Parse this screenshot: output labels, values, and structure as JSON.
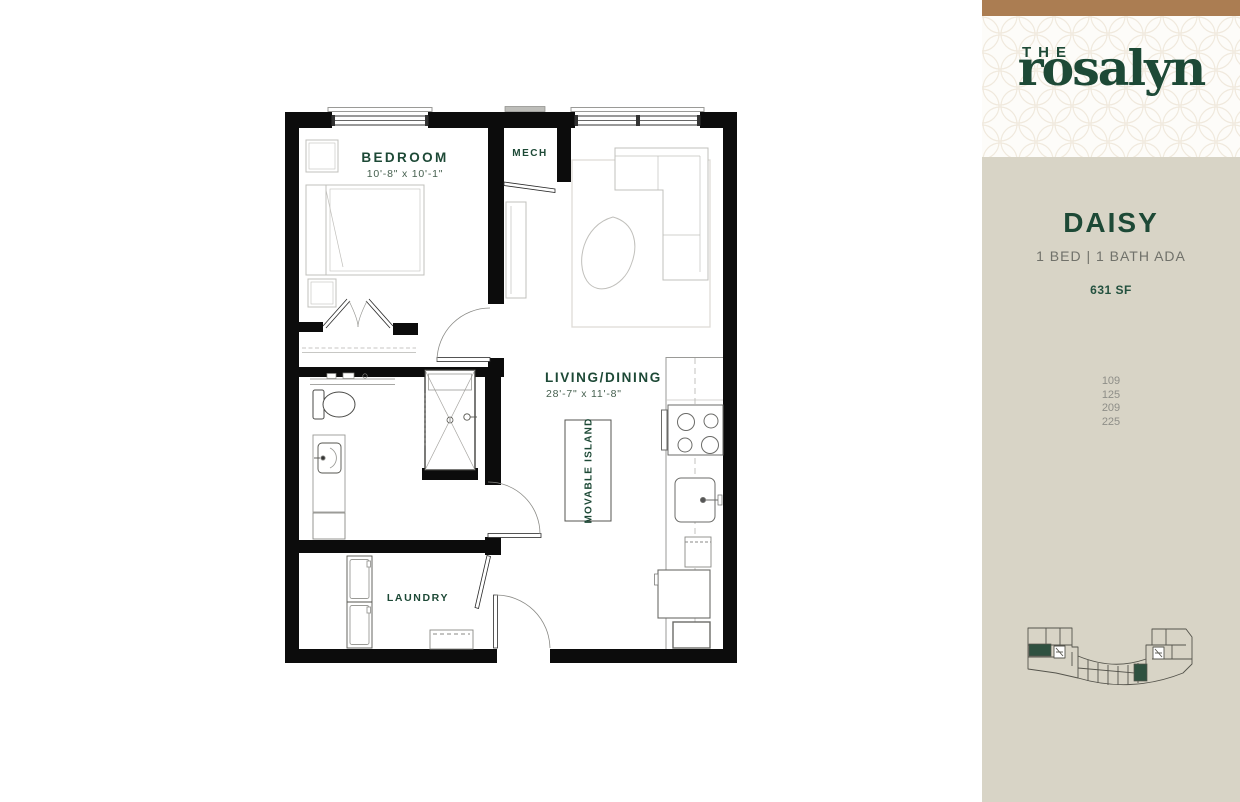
{
  "brand": {
    "the": "THE",
    "name": "rosalyn"
  },
  "unit": {
    "name": "DAISY",
    "specs": "1 BED | 1 BATH  ADA",
    "area": "631 SF",
    "numbers": [
      "109",
      "125",
      "209",
      "225"
    ]
  },
  "floorplan": {
    "bedroom": {
      "label": "BEDROOM",
      "dims": "10'-8\" x 10'-1\""
    },
    "mech": {
      "label": "MECH"
    },
    "living": {
      "label": "LIVING/DINING",
      "dims": "28'-7\" x 11'-8\""
    },
    "island": {
      "label": "MOVABLE ISLAND"
    },
    "laundry": {
      "label": "LAUNDRY"
    }
  },
  "colors": {
    "accent_green": "#1d4936",
    "bar_brown": "#ab7d52",
    "sidebar_beige": "#d8d4c6",
    "highlight_unit_green": "#2f5140"
  }
}
